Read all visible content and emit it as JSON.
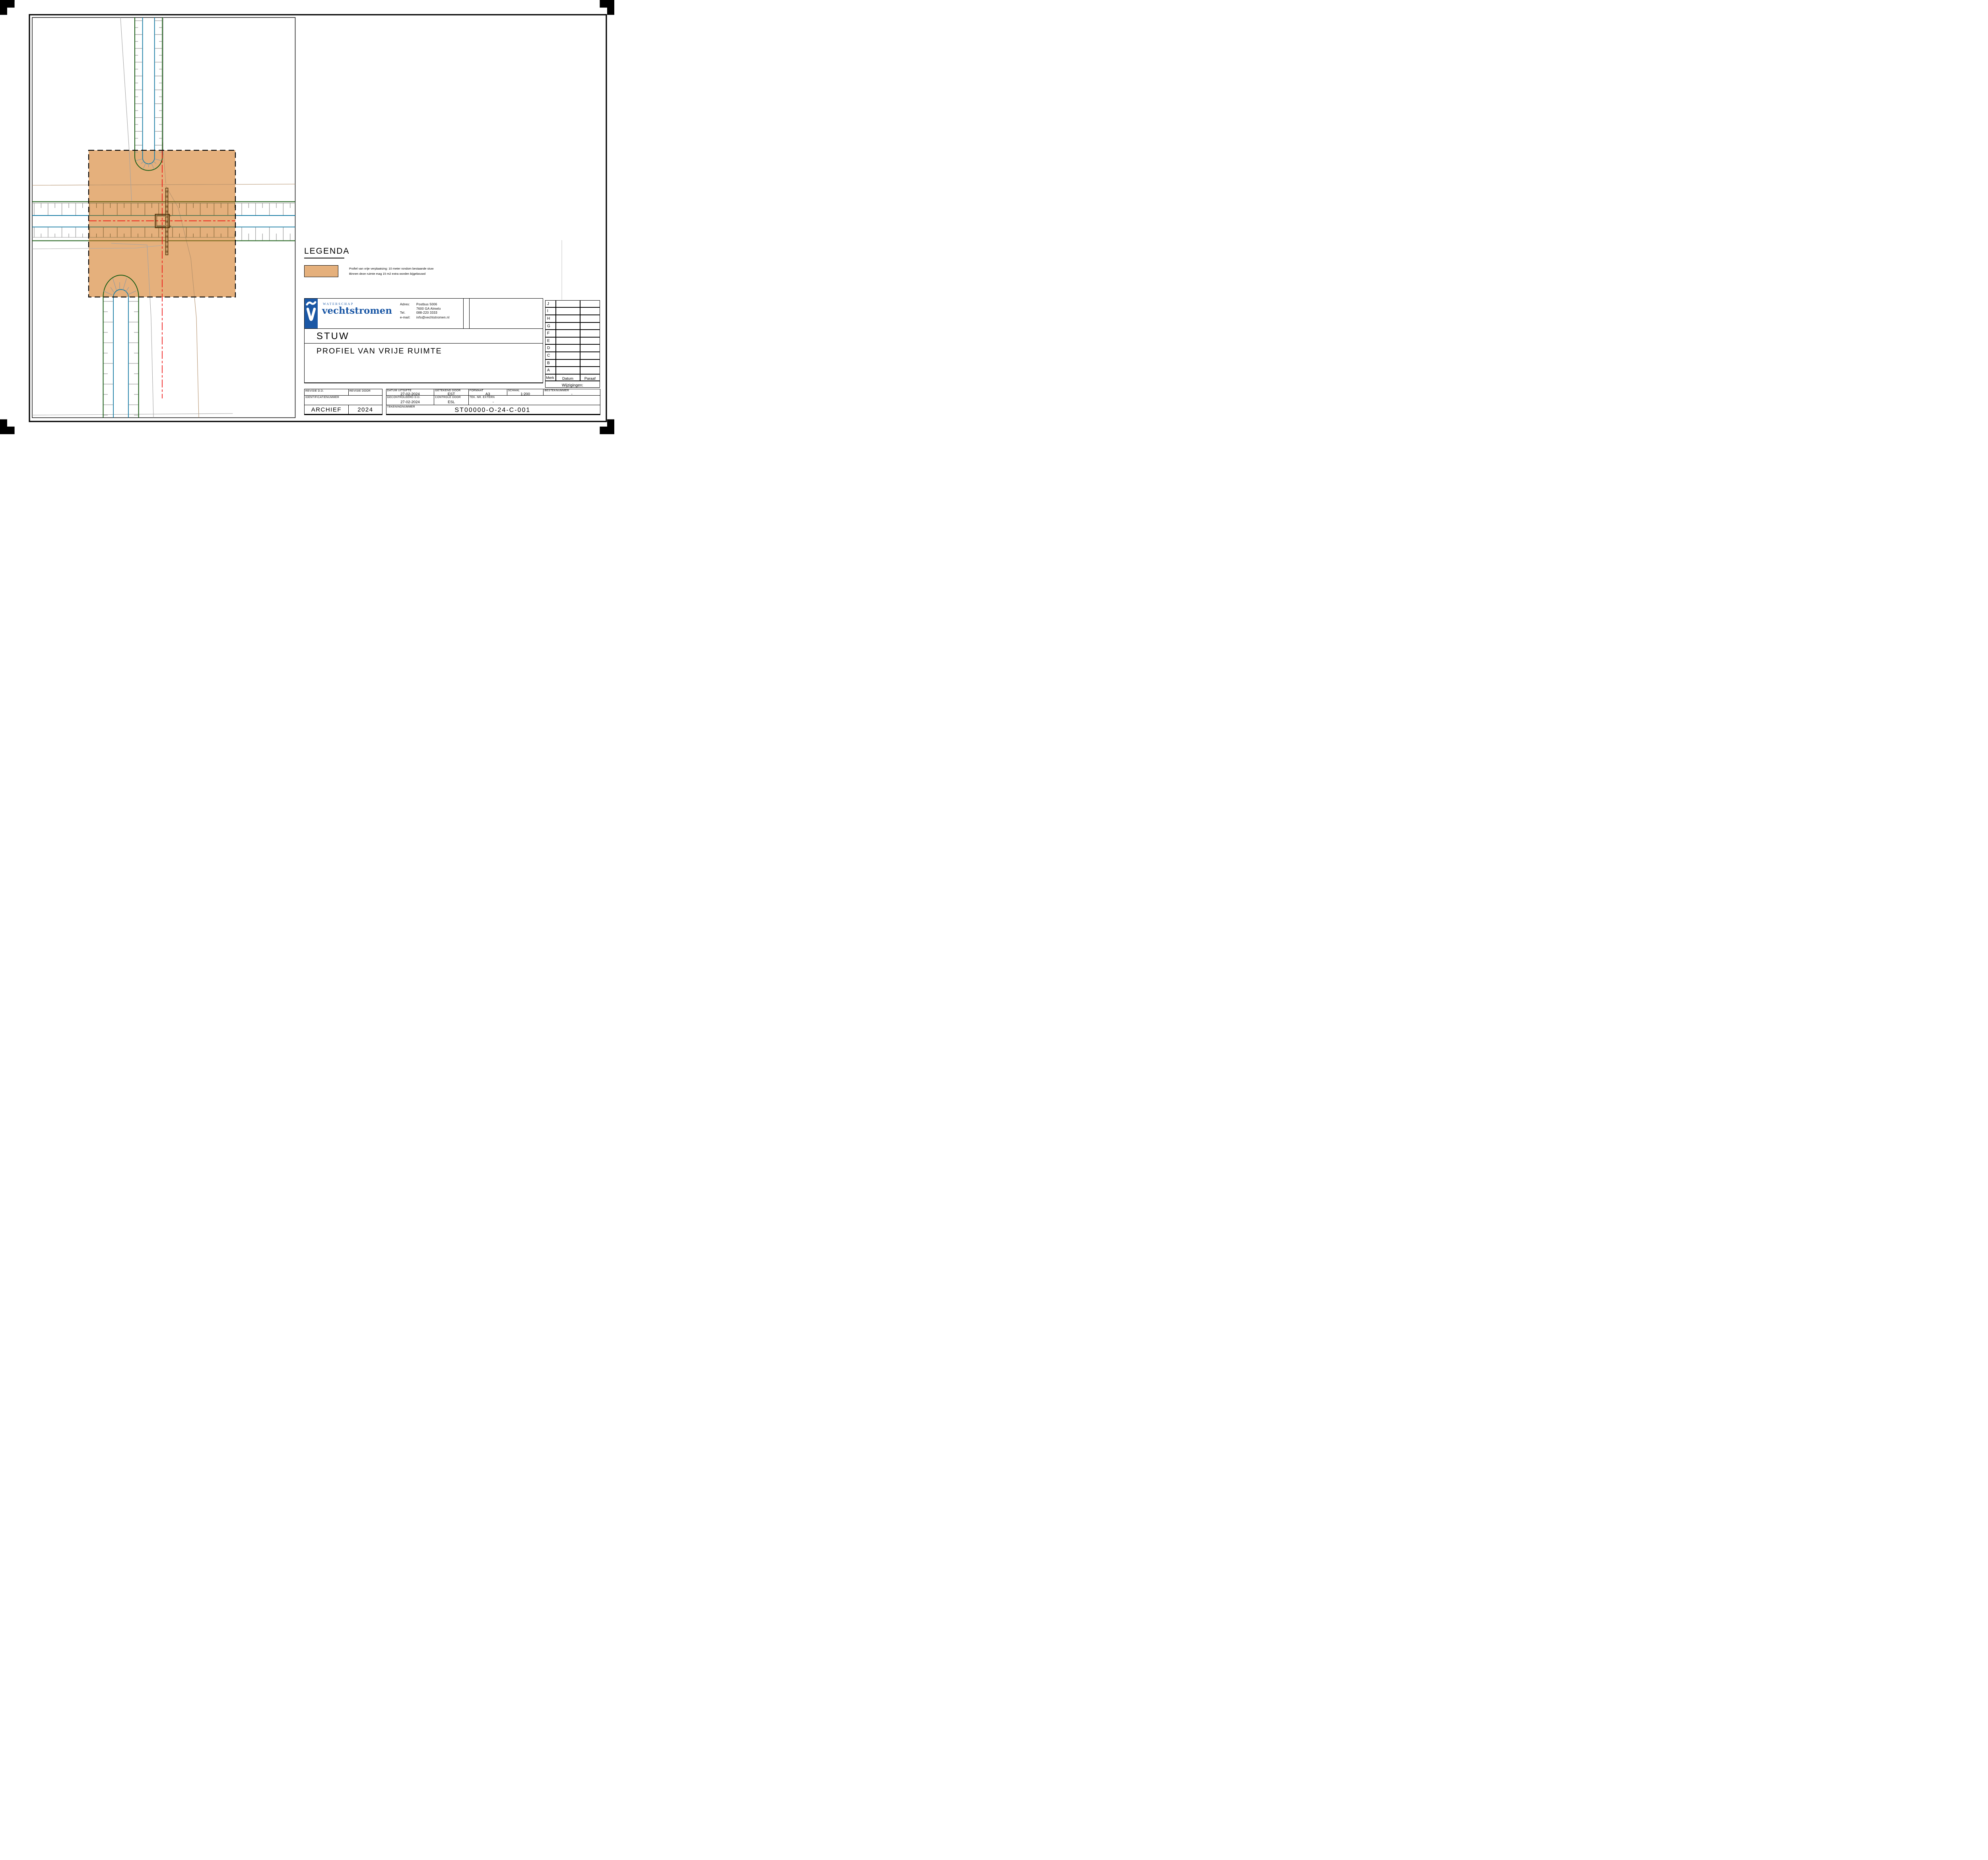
{
  "legend": {
    "title": "LEGENDA",
    "swatch_color": "#e5b07c",
    "line1": "Profiel van vrije verplaatsing: 10 meter rondom bestaande stuw",
    "line2": "Binnen deze ruimte mag 15 m2 extra worden bijgebouwd"
  },
  "logo": {
    "org_small": "WATERSCHAP",
    "org_name": "vechtstromen",
    "adres_label": "Adres:",
    "adres_line1": "Postbus 5006",
    "adres_line2": "7600 GA Almelo",
    "tel_label": "Tel.",
    "tel_value": "088-220 3333",
    "email_label": "e-mail:",
    "email_value": "info@vechtstromen.nl"
  },
  "titles": {
    "object": "STUW",
    "drawing": "PROFIEL VAN VRIJE RUIMTE"
  },
  "revision_table": {
    "rows": [
      "J",
      "I",
      "H",
      "G",
      "F",
      "E",
      "D",
      "C",
      "B",
      "A"
    ],
    "merk_header": "Merk",
    "datum_header": "Datum",
    "paraaf_header": "Paraaf",
    "footer": "Wijzigingen:"
  },
  "title_block": {
    "revisie_dd_label": "REVISIE D.D.",
    "revisie_door_label": "REVISIE DOOR",
    "identificatienummer_label": "IDENTIFICATIENUMMER",
    "archief": "ARCHIEF",
    "archief_jaar": "2024",
    "datum_uitgifte_label": "DATUM UITGIFTE",
    "datum_uitgifte": "27-02-2024",
    "getekend_door_label": "GETEKEND DOOR",
    "getekend_door": "EST",
    "gecontroleerd_dd_label": "GECONTROLEERD D.D.",
    "gecontroleerd_dd": "27-02-2024",
    "controle_door_label": "CONTROLE DOOR",
    "controle_door": "ESL",
    "formaat_label": "FORMAAT",
    "formaat": "A3",
    "schaal_label": "SCHAAL",
    "schaal": "1:200",
    "besteknummer_label": "BESTEKNUMMER",
    "besteknummer": "-",
    "tek_nr_extern_label": "TEK. NR. EXTERN",
    "tek_nr_extern": "-",
    "tekeningnummer_label": "TEKENINGNUMMER",
    "tekeningnummer": "ST00000-O-24-C-001"
  },
  "colors": {
    "zone_orange": "#e5b07c",
    "bank_green": "#185c14",
    "water_blue": "#1d7fa6",
    "hatch_gray": "#9b9b9b",
    "centerline_red": "#ee1111",
    "structure_brown": "#53320a",
    "logo_blue": "#1a57a5"
  }
}
